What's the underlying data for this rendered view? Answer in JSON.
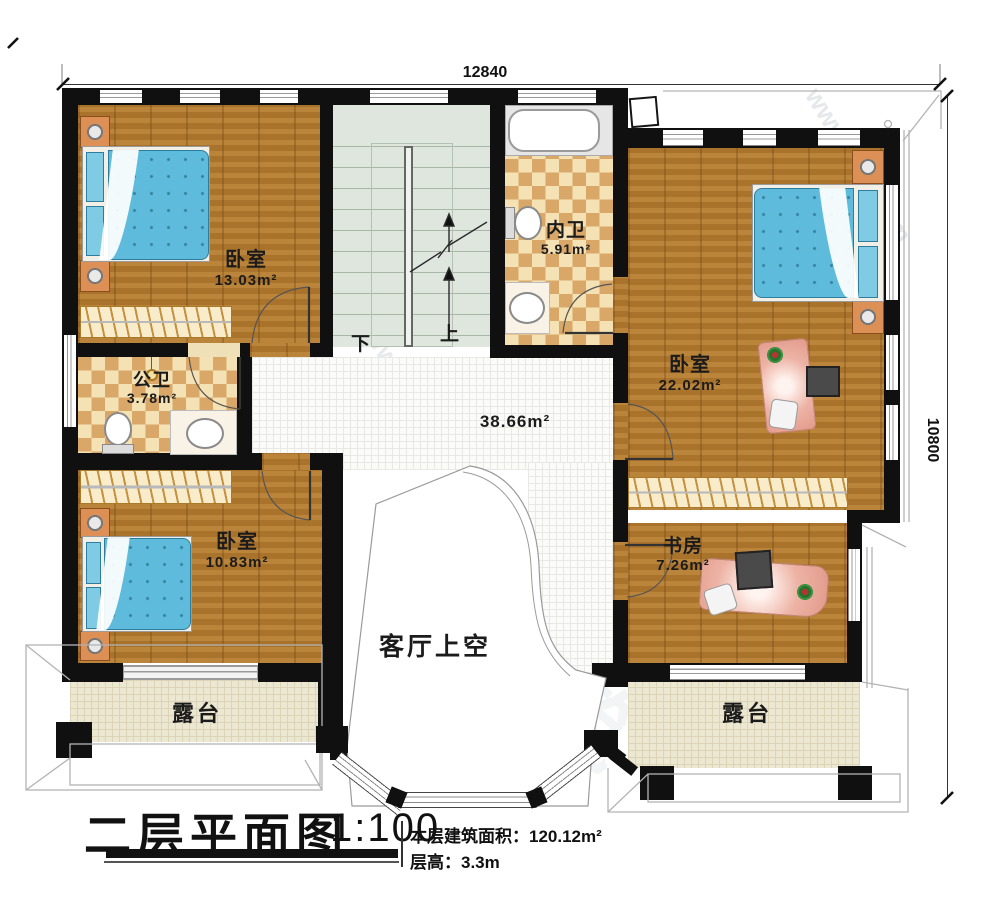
{
  "dimensions": {
    "top": "12840",
    "right": "10800"
  },
  "titleblock": {
    "title": "二层平面图",
    "scale": "1:100",
    "floor_area": "本层建筑面积：120.12m²",
    "floor_height": "层高：3.3m"
  },
  "rooms": {
    "bedroom_nw": {
      "label": "卧室",
      "area": "13.03m²"
    },
    "bath_inner": {
      "label": "内卫",
      "area": "5.91m²"
    },
    "bedroom_e": {
      "label": "卧室",
      "area": "22.02m²"
    },
    "bath_public": {
      "label": "公卫",
      "area": "3.78m²"
    },
    "bedroom_sw": {
      "label": "卧室",
      "area": "10.83m²"
    },
    "study": {
      "label": "书房",
      "area": "7.26m²"
    },
    "hall": {
      "area": "38.66m²"
    },
    "living_void": {
      "label": "客厅上空"
    },
    "terrace_left": {
      "label": "露台"
    },
    "terrace_right": {
      "label": "露台"
    }
  },
  "stairs": {
    "down": "下",
    "up": "上"
  },
  "watermark": {
    "site": "www.bzjz.com",
    "brand": "柏筑"
  },
  "colors": {
    "wall": "#101010",
    "wood": "#b2792f",
    "tile_light": "#f4e2b4",
    "tile_dark": "#d9a869",
    "stair": "#dee6de",
    "terrace": "#ece7d1",
    "bed_blue": "#5fbbdb"
  }
}
